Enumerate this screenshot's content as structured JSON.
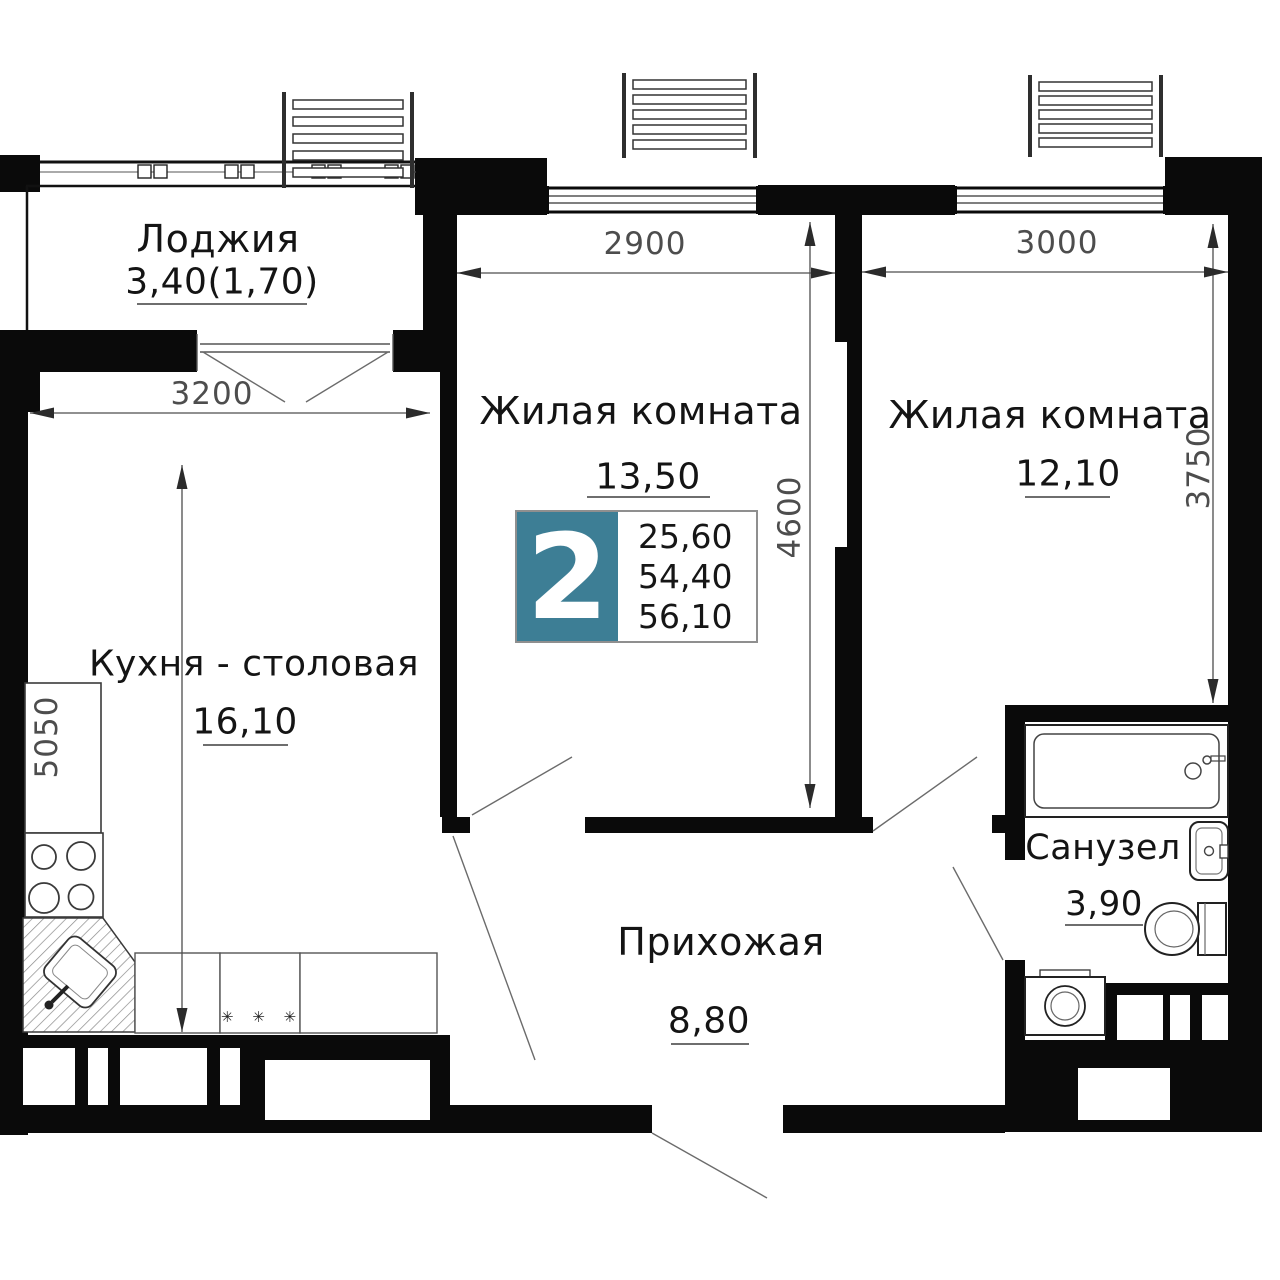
{
  "plan": {
    "badge": {
      "room_count": "2",
      "area_lines": [
        "25,60",
        "54,40",
        "56,10"
      ]
    },
    "rooms": {
      "loggia": {
        "name": "Лоджия",
        "area": "3,40(1,70)"
      },
      "living1": {
        "name": "Жилая комната",
        "area": "13,50"
      },
      "living2": {
        "name": "Жилая комната",
        "area": "12,10"
      },
      "kitchen": {
        "name": "Кухня - столовая",
        "area": "16,10"
      },
      "hallway": {
        "name": "Прихожая",
        "area": "8,80"
      },
      "bathroom": {
        "name": "Санузел",
        "area": "3,90"
      }
    },
    "dims": {
      "kitchen_width": "3200",
      "kitchen_depth": "5050",
      "living1_width": "2900",
      "living1_depth": "4600",
      "living2_width": "3000",
      "living2_depth": "3750"
    },
    "symbols": {
      "hob_marks": "✳ ✳ ✳"
    },
    "colors": {
      "wall": "#0a0a0a",
      "accent": "#3d7e95",
      "dim_text": "#4d4d4d",
      "label_text": "#141414"
    }
  }
}
